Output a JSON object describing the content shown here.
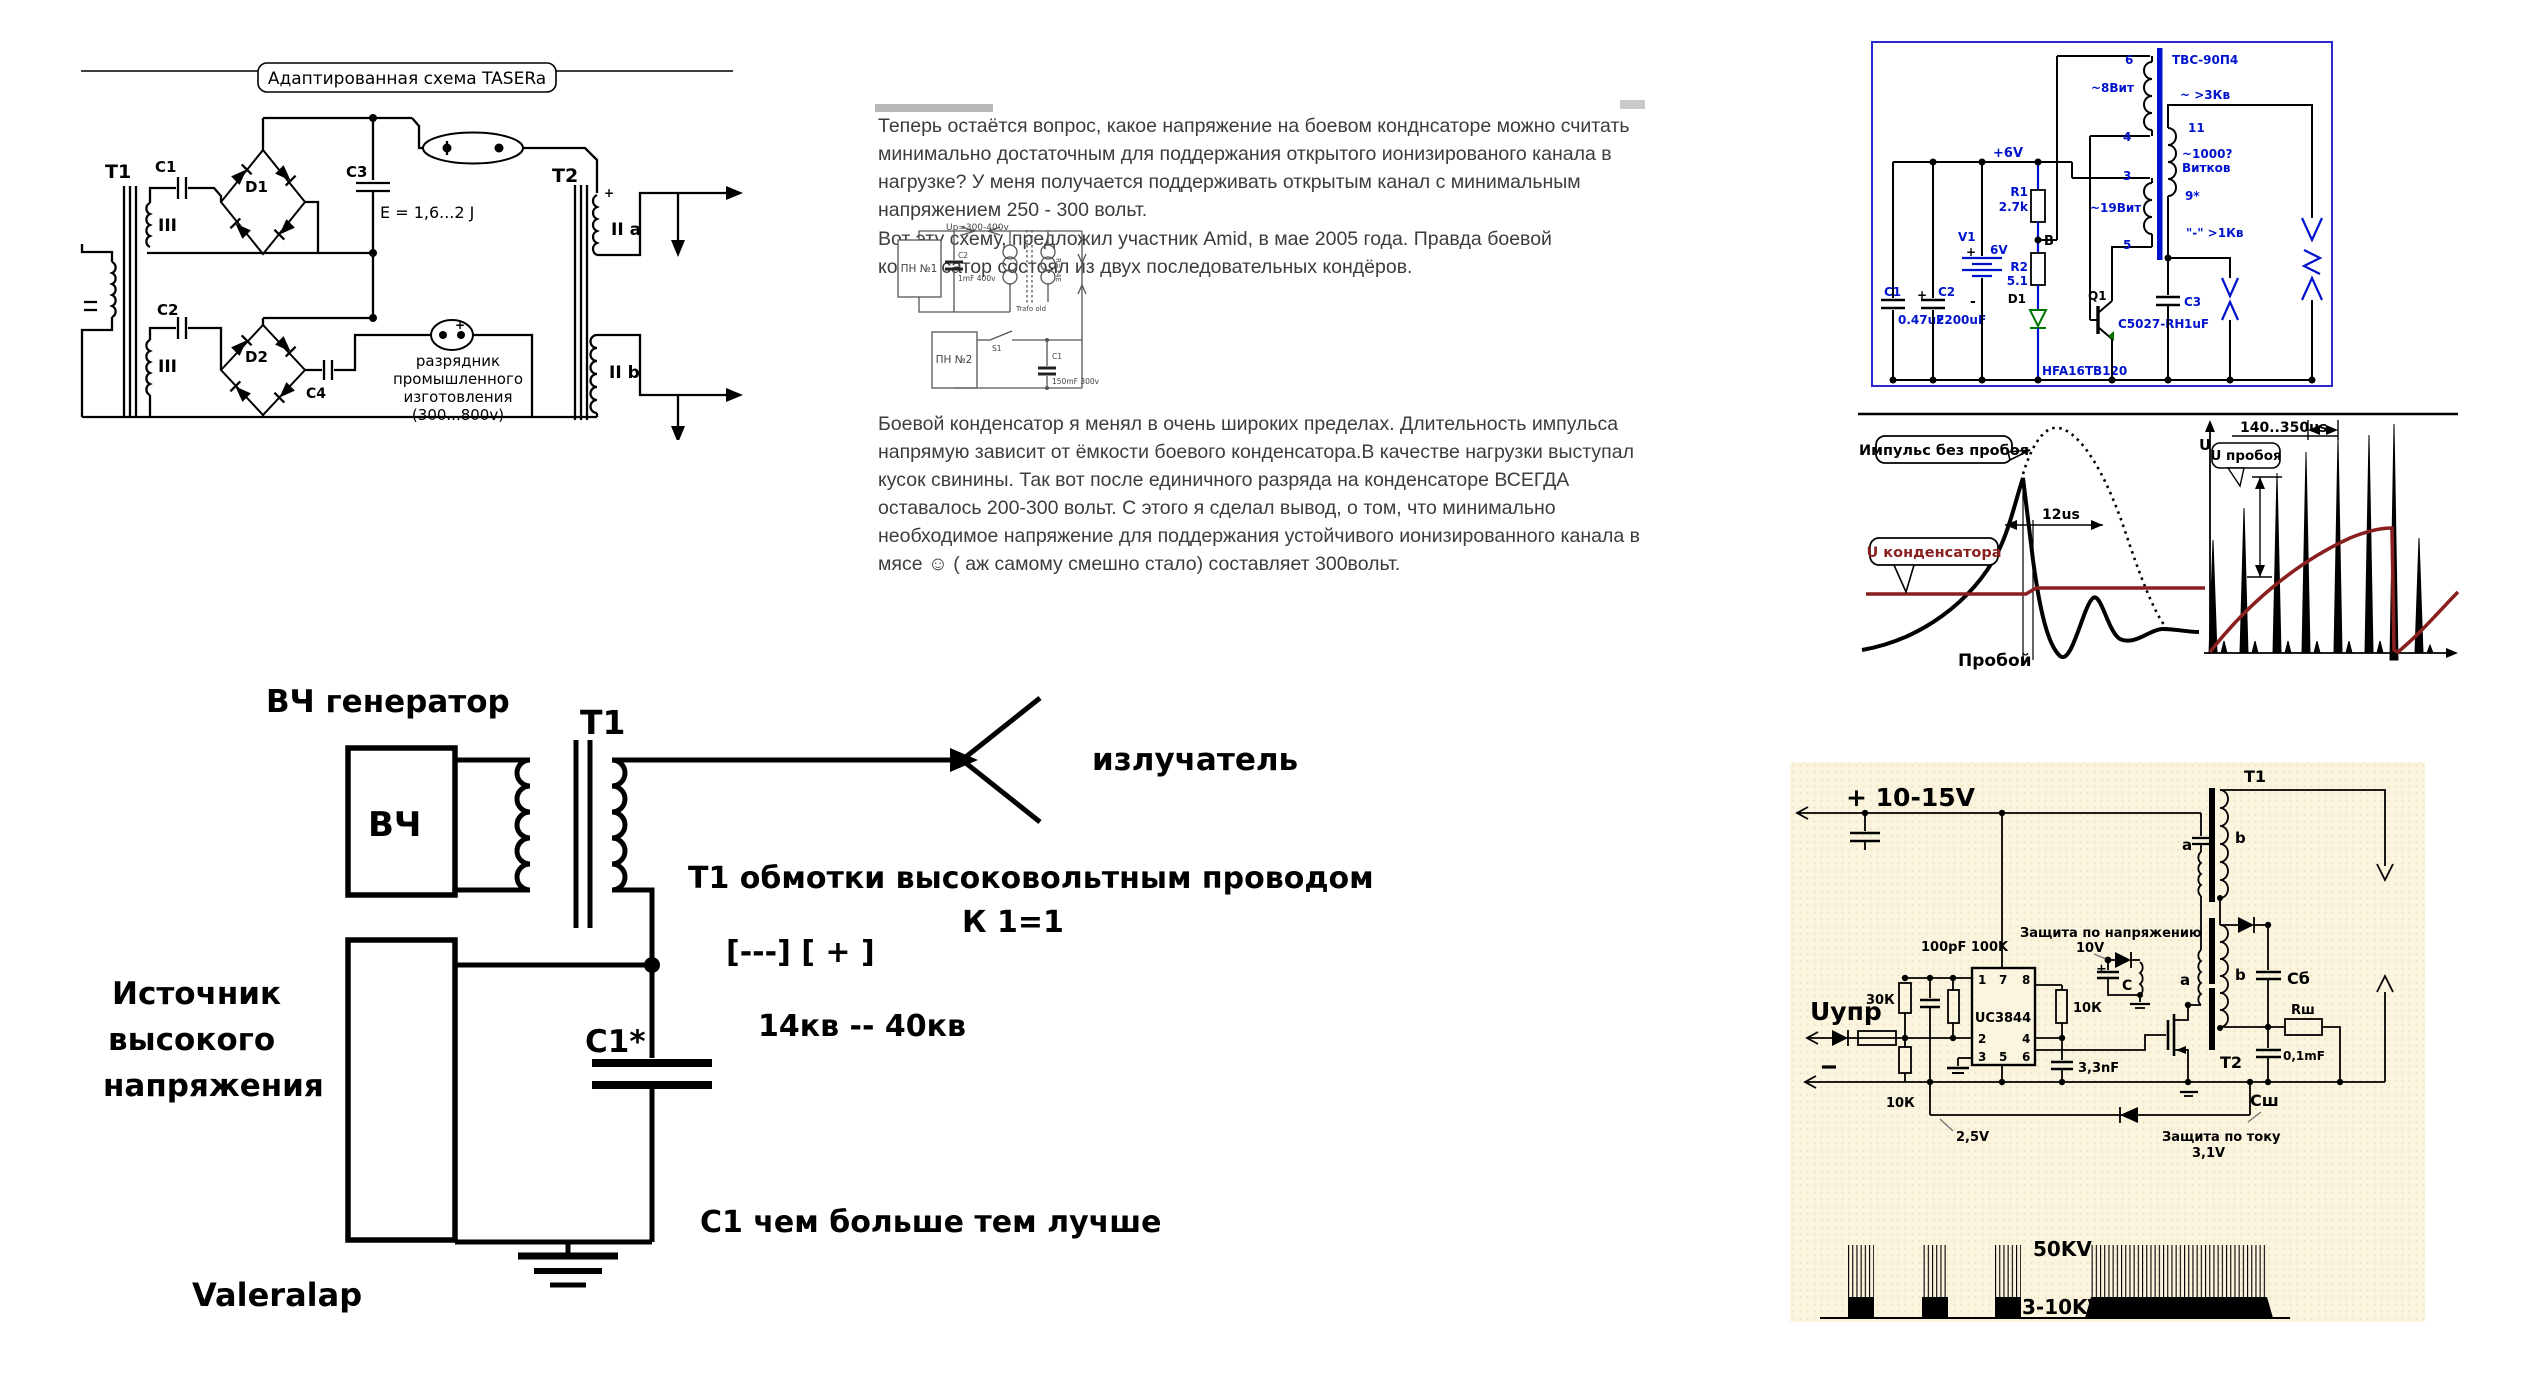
{
  "taser": {
    "title": "Адаптированная схема TASERa",
    "t1": "T1",
    "c1": "C1",
    "d1": "D1",
    "w3_top": "III",
    "w3_bot": "III",
    "c2": "C2",
    "d2": "D2",
    "c4": "C4",
    "c3": "C3",
    "energy": "E = 1,6...2 J",
    "gap1": "самодельный разрядник  (3...5 Kv)",
    "gap2_line1": "разрядник",
    "gap2_line2": "промышленного",
    "gap2_line3": "изготовления",
    "gap2_line4": "(300...800v)",
    "t2": "T2",
    "w2a": "II a",
    "w2b": "II b",
    "plus_a": "+",
    "plus_b": "+"
  },
  "post": {
    "para1": "Теперь остаётся вопрос, какое напряжение на боевом конднсаторе можно считать минимально достаточным для поддержания открытого ионизированого канала в нагрузке? У меня получается поддерживать открытым канал с минимальным напряжением 250 - 300 вольт.",
    "para2": "Вот эту схему, предложил участник Amid, в мае 2005 года. Правда боевой конденсатор состоял из двух последовательных кондёров.",
    "para3": "Боевой конденсатор я менял в очень широких пределах. Длительность импульса напрямую зависит от ёмкости боевого конденсатора.В качестве нагрузки выступал кусок свинины. Так вот после единичного разряда на конденсаторе ВСЕГДА оставалось 200-300 вольт. С этого я сделал вывод, о том, что минимально необходимое напряжение для поддержания устойчивого ионизированного канала в мясе ☺ ( аж самому смешно стало) составляет 300вольт."
  },
  "mini": {
    "up_label": "Up=300-400v",
    "pn1": "ПН №1",
    "pn2": "ПН №2",
    "c2": "C2",
    "c2_val": "1mF 400v",
    "trafo": "Trafo old",
    "r_val": "R=14E",
    "s1": "S1",
    "c1": "C1",
    "c1_val": "150mF 300v"
  },
  "blue": {
    "rail": "+6V",
    "c1": "C1",
    "c1_val": "0.47uF",
    "c2": "C2",
    "c2_val": "2200uF",
    "c2_plus": "+",
    "v1": "V1",
    "v1_val": "6V",
    "v1_plus": "+",
    "v1_minus": "-",
    "r1": "R1",
    "r1_val": "2.7k",
    "b": "B",
    "r2": "R2",
    "r2_val": "5.1",
    "d1": "D1",
    "d1_part": "HFA16TB120",
    "q1": "Q1",
    "q1_part": "C5027-RH",
    "p6": "6",
    "p4": "4",
    "w1": "~8Вит",
    "p3": "3",
    "p5": "5",
    "w2": "~19Вит",
    "core": "ТВС-90П4",
    "hv1": "~ >3Кв",
    "p11": "11",
    "p9": "9*",
    "turns1": "~1000?",
    "turns2": "Витков",
    "hv2": "\"-\" >1Кв",
    "c3": "C3",
    "c3_val": "1uF"
  },
  "scope": {
    "callout1": "Импульс без пробоя",
    "callout2": "U конденсатора",
    "t12": "12us",
    "breakdown": "Пробой",
    "u_axis": "U",
    "t140": "140..350us",
    "callout3": "U пробоя"
  },
  "hand": {
    "gen": "ВЧ генератор",
    "t1": "Т1",
    "vch": "ВЧ",
    "emitter": "излучатель",
    "winding_note": "Т1 обмотки   высоковольтным проводом",
    "k": "К 1=1",
    "polarity": "[---] [ + ]",
    "kv": "14кв -- 40кв",
    "src1": "Источник",
    "src2": "высокого",
    "src3": "напряжения",
    "c1": "С1*",
    "c1_note": "С1 чем больше   тем лучше",
    "author": "Valeralap"
  },
  "beige": {
    "supply": "+ 10-15V",
    "rc": "100pF  100K",
    "vprot1": "Защита по напряжению",
    "vprot2": "10V",
    "uctrl": "Uупр",
    "r30": "30К",
    "r10a": "10К",
    "chip": "UC3844",
    "p1": "1",
    "p7": "7",
    "p8": "8",
    "p2": "2",
    "p4": "4",
    "p3": "3",
    "p5": "5",
    "p6": "6",
    "r10b": "10К",
    "c33": "3,3nF",
    "ref": "2,5V",
    "iprot1": "Защита по току",
    "iprot2": "3,1V",
    "t1": "Т1",
    "a1": "a",
    "b1": "b",
    "a2": "a",
    "b2": "b",
    "t2": "Т2",
    "c": "С",
    "cb": "Сб",
    "rsh": "Rш",
    "c01": "0,1mF",
    "csh": "Сш",
    "kv50": "50KV",
    "kv310": "3-10KV"
  }
}
